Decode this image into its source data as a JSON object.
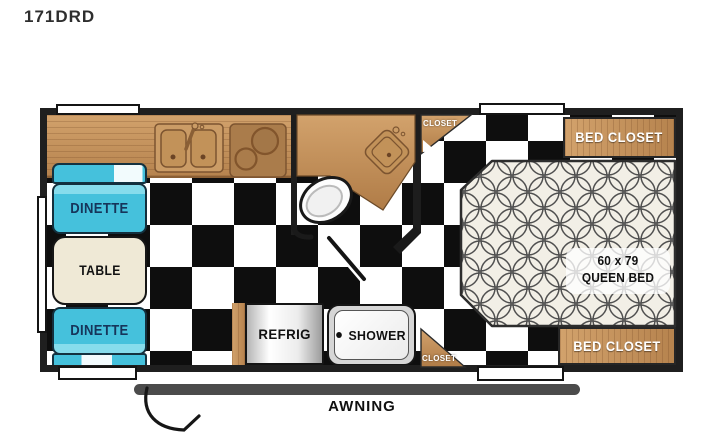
{
  "title": "171DRD",
  "colors": {
    "wall": "#1f1f1f",
    "checker_black": "#0e0e0e",
    "checker_white": "#ffffff",
    "wood": "#c4945e",
    "wood_dark": "#aa7c4b",
    "dinette_cyan": "#45c1dc",
    "dinette_text": "#16355a",
    "table_cream": "#efe9d6",
    "bed_pattern_bg": "#f2efe6",
    "bed_pattern_line": "#4f4f4f",
    "awning_bar": "#4b4b4b"
  },
  "dinette": {
    "bench_top_label": "DINETTE",
    "table_label": "TABLE",
    "bench_bottom_label": "DINETTE"
  },
  "bath": {
    "shower_label": "SHOWER",
    "closet_top_label": "CLOSET",
    "closet_bottom_label": "CLOSET"
  },
  "appliances": {
    "refrig_label": "REFRIG"
  },
  "bedroom": {
    "bed_closet_top_label": "BED CLOSET",
    "bed_size": "60 x 79",
    "bed_type": "QUEEN BED",
    "bed_closet_bottom_label": "BED CLOSET"
  },
  "exterior": {
    "awning_label": "AWNING"
  }
}
